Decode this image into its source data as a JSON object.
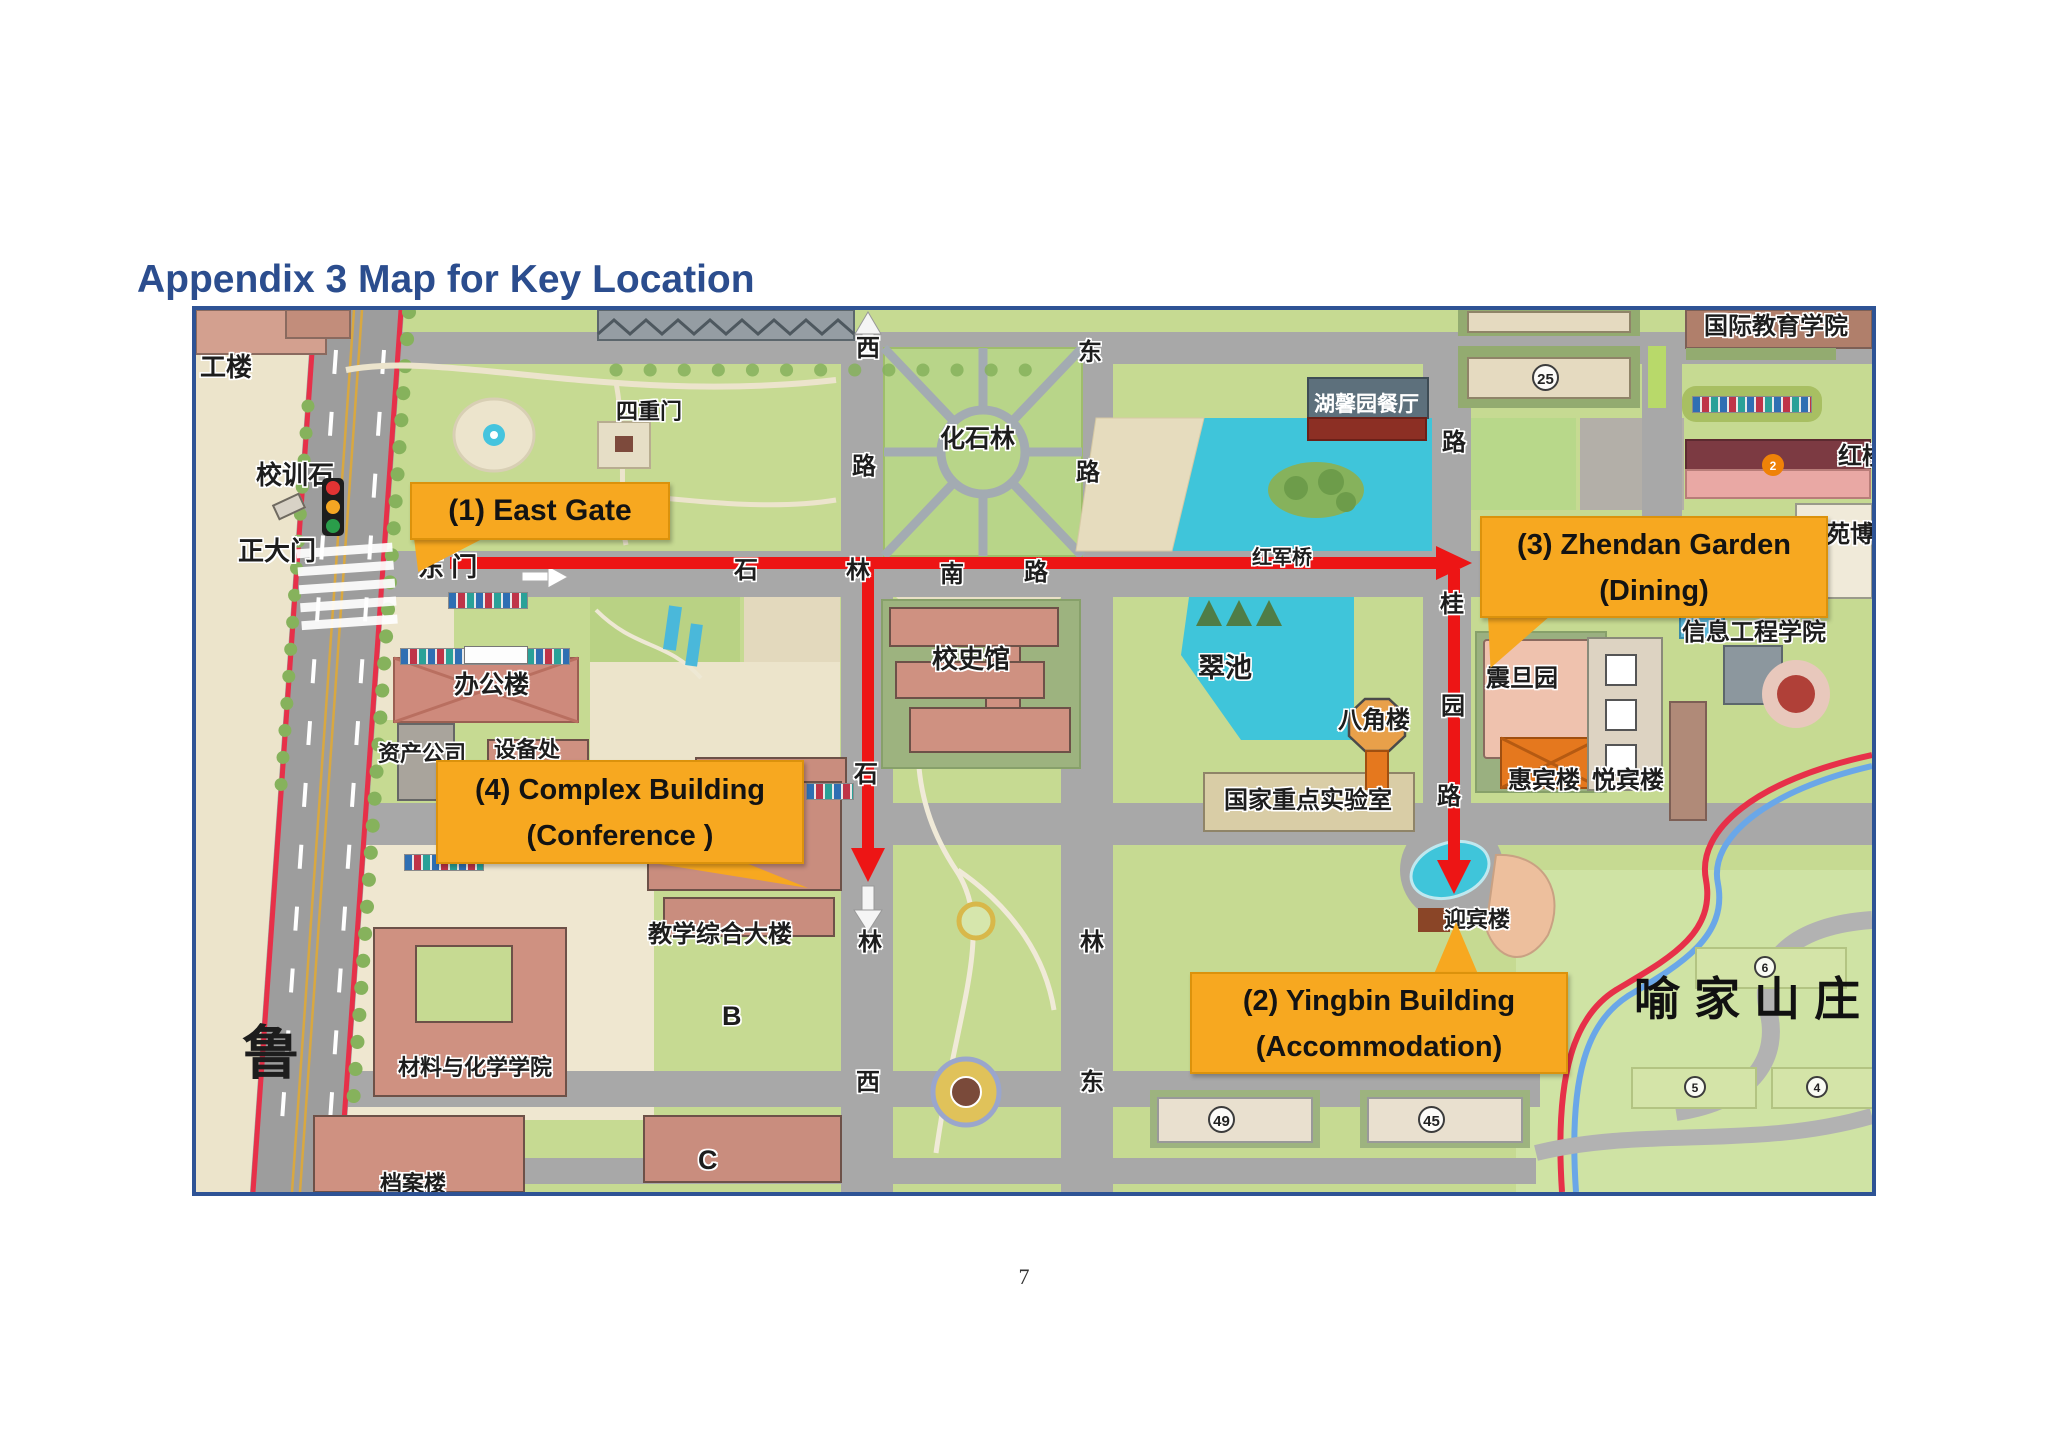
{
  "page": {
    "title": "Appendix 3 Map for Key Location",
    "page_number": "7"
  },
  "callouts": {
    "east_gate": {
      "label": "(1) East Gate"
    },
    "yingbin": {
      "line1": "(2) Yingbin Building",
      "line2": "(Accommodation)"
    },
    "zhendan": {
      "line1": "(3) Zhendan Garden",
      "line2": "(Dining)"
    },
    "complex": {
      "line1": "(4) Complex Building",
      "line2": "(Conference )"
    }
  },
  "labels": {
    "gonglou": "工楼",
    "xiaoxunshi": "校训石",
    "zhengdamen": "正大门",
    "dongmen": "东 门",
    "sichongmen": "四重门",
    "huashilin": "化石林",
    "bangonglou": "办公楼",
    "zichangongsi": "资产公司",
    "shebeichu": "设备处",
    "xiaoshiguan": "校史馆",
    "jiaoxuezonghedalou": "教学综合大楼",
    "building_b": "B",
    "building_c": "C",
    "cailiaoyuhuaxue": "材料与化学学院",
    "danganlou": "档案楼",
    "lu": "鲁",
    "huxinyuancanting": "湖馨园餐厅",
    "hongjunqiao": "红军桥",
    "cuichi": "翠池",
    "bajiaolou": "八角楼",
    "guojiazhongdianshiyanshi": "国家重点实验室",
    "zhendanyuan": "震旦园",
    "huibinlou": "惠宾楼",
    "yuebinlou": "悦宾楼",
    "yingbinlou": "迎宾楼",
    "guojijiaoyuxueyuan": "国际教育学院",
    "xinxigongchengxueyuan": "信息工程学院",
    "honglou": "红楼",
    "yuanbo": "苑博",
    "yujiashanzhuang": "喻家山庄"
  },
  "road_chars": {
    "v1_xi": "西",
    "v1_lu": "路",
    "v1_shi": "石",
    "v1_lin": "林",
    "v1_xi2": "西",
    "v2_dong": "东",
    "v2_lu": "路",
    "v2_lin": "林",
    "v2_dong2": "东",
    "h_shi": "石",
    "h_lin": "林",
    "h_nan": "南",
    "h_lu": "路",
    "v3_lu": "路",
    "v3_gui": "桂",
    "v3_yuan": "园",
    "v3_lu2": "路"
  },
  "badges": {
    "b25": "25",
    "b2": "2",
    "b49": "49",
    "b45": "45",
    "b6": "6",
    "b5": "5",
    "b4": "4"
  },
  "colors": {
    "callout_amber": "#F7A820",
    "route_red": "#ED1515",
    "water_cyan": "#3FC5DA",
    "title_blue": "#2B4D8E",
    "map_border_blue": "#2E5395",
    "road_gray": "#A8A8A8",
    "building_salmon": "#CF9181"
  }
}
